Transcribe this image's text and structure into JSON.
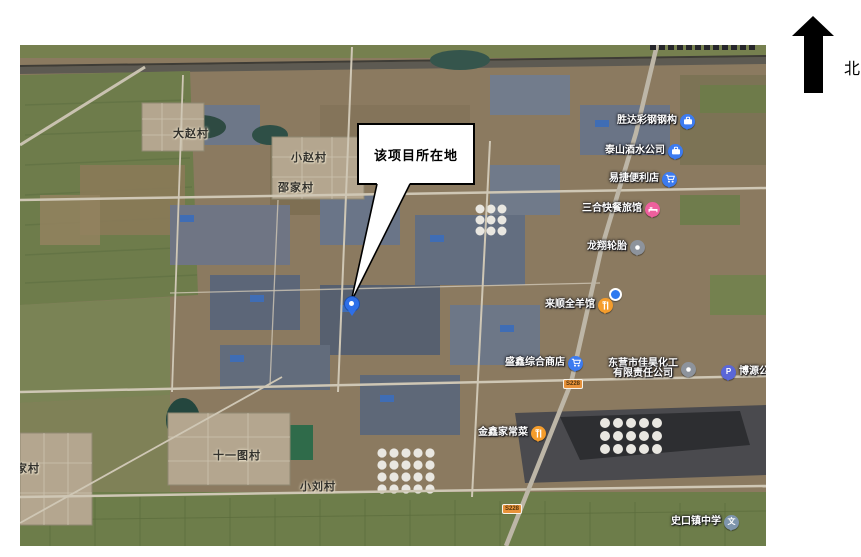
{
  "compass": {
    "label": "北"
  },
  "callout": {
    "text": "该项目所在地"
  },
  "map": {
    "villages": [
      {
        "text": "大赵村"
      },
      {
        "text": "小赵村"
      },
      {
        "text": "邵家村"
      },
      {
        "text": "十一图村"
      },
      {
        "text": "小刘村"
      },
      {
        "text": "家村"
      }
    ],
    "pois": [
      {
        "label": "胜达彩钢钢构",
        "icon": "briefcase",
        "pin_color": "#3c7bf0"
      },
      {
        "label": "泰山酒水公司",
        "icon": "briefcase",
        "pin_color": "#3c7bf0"
      },
      {
        "label": "易捷便利店",
        "icon": "shopping-cart",
        "pin_color": "#3c7bf0"
      },
      {
        "label": "三合快餐旅馆",
        "icon": "bed",
        "pin_color": "#ee5f9d"
      },
      {
        "label": "龙翔轮胎",
        "icon": "dot",
        "pin_color": "#8d939c"
      },
      {
        "label": "来顺全羊馆",
        "icon": "fork-knife",
        "pin_color": "#f59d2c"
      },
      {
        "label": "盛鑫综合商店",
        "icon": "shopping-cart",
        "pin_color": "#3c7bf0"
      },
      {
        "label_line1": "东营市佳昊化工",
        "label_line2": "有限责任公司",
        "icon": "dot",
        "pin_color": "#8d939c"
      },
      {
        "label": "博源公司",
        "icon": "parking",
        "pin_color": "#5a67d8"
      },
      {
        "label": "金鑫家常菜",
        "icon": "fork-knife",
        "pin_color": "#f59d2c"
      },
      {
        "label": "史口镇中学",
        "icon": "school",
        "pin_color": "#7e95ac"
      }
    ],
    "shields": [
      {
        "text": "S228"
      },
      {
        "text": "S228"
      }
    ],
    "icon_glyphs": {
      "parking": "P",
      "school": "文"
    },
    "colors": {
      "poi_pin_blue": "#3c7bf0",
      "poi_pin_pink": "#ee5f9d",
      "poi_pin_orange": "#f59d2c",
      "poi_pin_gray": "#8d939c",
      "parking_pin": "#5a67d8",
      "school_pin": "#7e95ac",
      "road_shield": "#e8923a",
      "project_marker_blue": "#2e6fe8"
    }
  }
}
